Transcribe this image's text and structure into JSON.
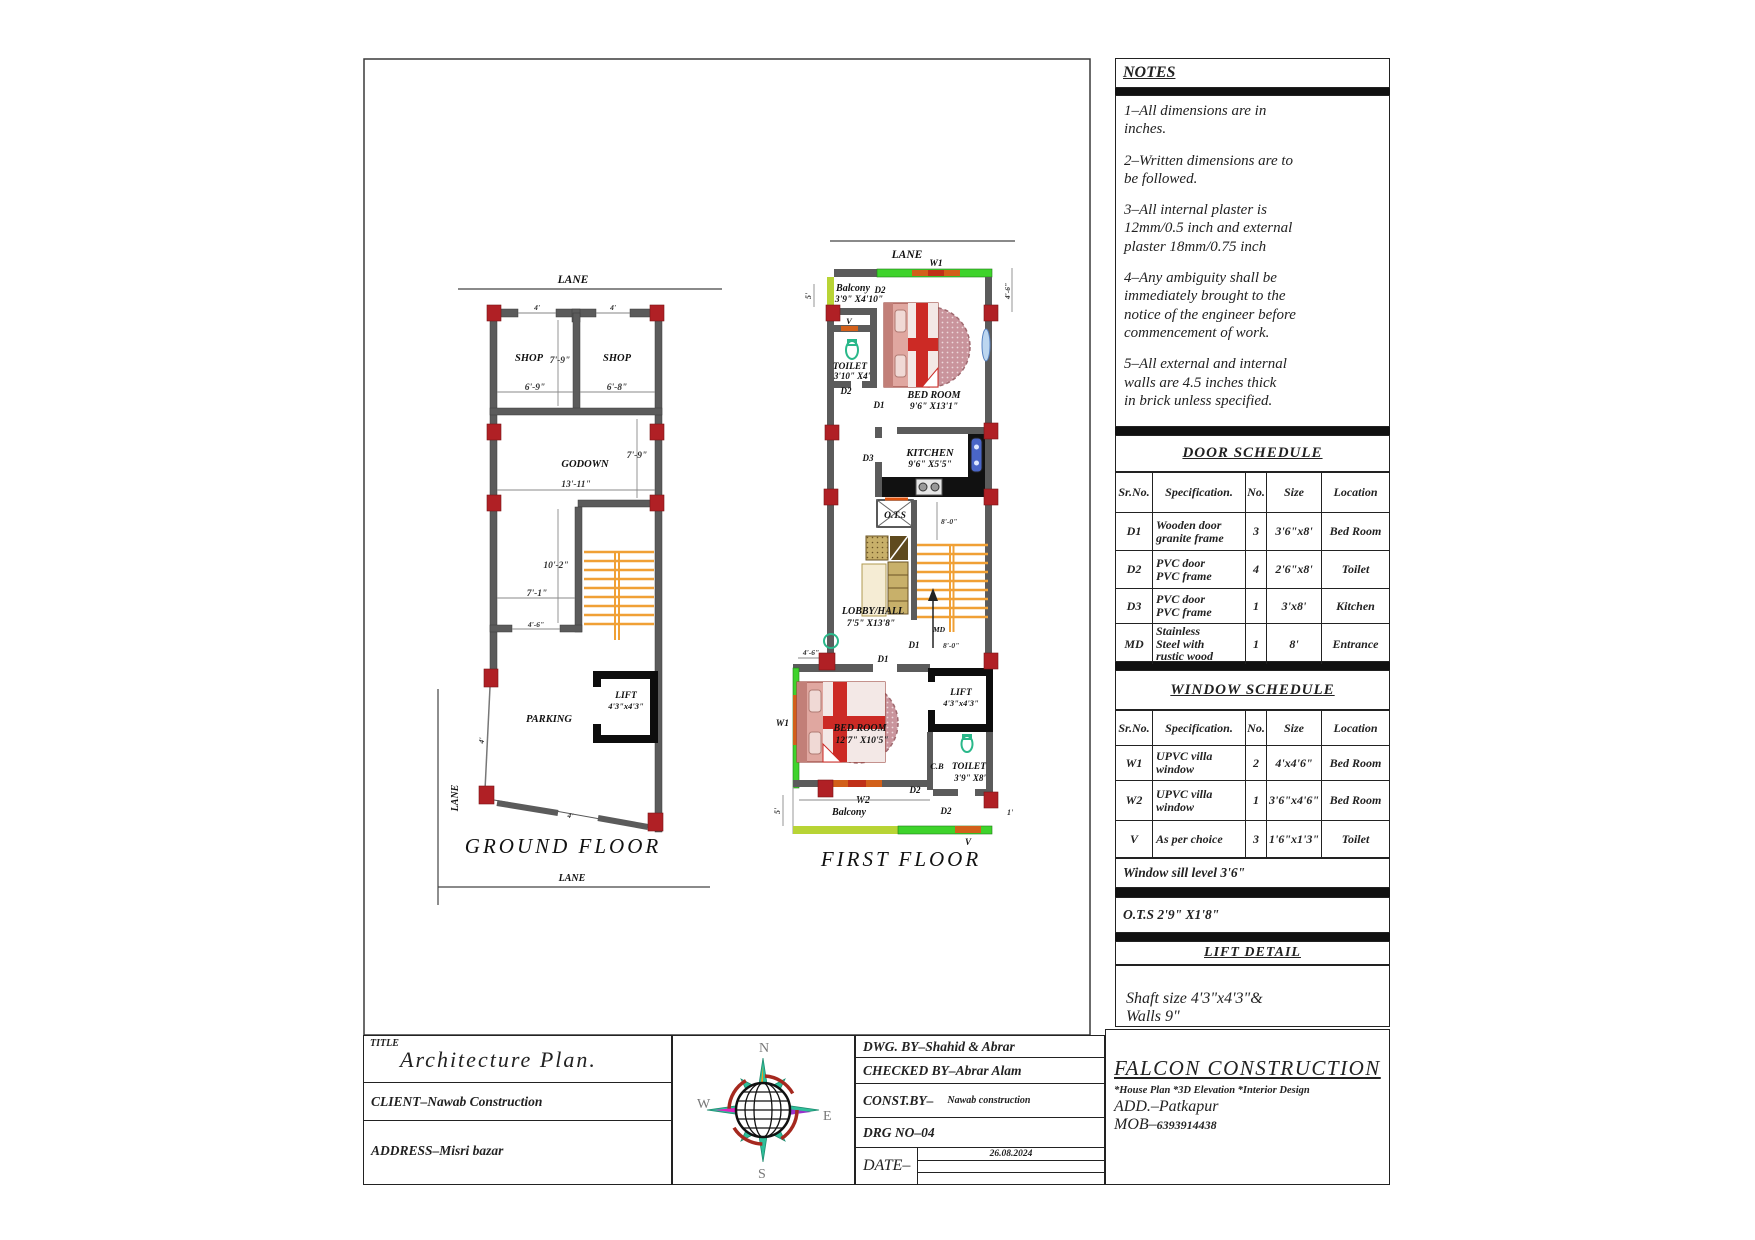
{
  "colors": {
    "wall": "#5b5b5b",
    "column": "#b02025",
    "stair": "#f0a035",
    "green": "#3ed32b",
    "lime": "#b8d435",
    "window_orange": "#d2601a",
    "shaft_black": "#0d0d0d",
    "teal": "#2ab88a",
    "basin_blue": "#4a66c8",
    "bed_red": "#cc2a25"
  },
  "ground_floor": {
    "title": "GROUND FLOOR",
    "lane_top": "LANE",
    "lane_bottom": "LANE",
    "lane_left": "LANE",
    "shop1": "SHOP",
    "shop2": "SHOP",
    "godown": "GODOWN",
    "parking": "PARKING",
    "lift": "LIFT",
    "lift_size": "4'3\"x4'3\"",
    "dim_shop_h": "7'-9\"",
    "dim_shop1_w": "6'-9\"",
    "dim_shop2_w": "6'-8\"",
    "dim_godown_h": "7'-9\"",
    "dim_godown_w": "13'-11\"",
    "dim_hall_h": "10'-2\"",
    "dim_hall_w": "7'-1\"",
    "dim_stair": "4'-6\"",
    "dim_door1": "4'",
    "dim_door2": "4'",
    "dim_slant_left": "4'",
    "dim_slant_bottom": "4'"
  },
  "first_floor": {
    "title": "FIRST FLOOR",
    "lane_top": "LANE",
    "w1_top": "W1",
    "balcony_top": "Balcony",
    "balcony_top_size": "3'9\" X4'10\"",
    "d2_balcony": "D2",
    "v_toilet": "V",
    "toilet1": "TOILET",
    "toilet1_size": "3'10\" X4'",
    "d2_toilet": "D2",
    "bedroom1": "BED ROOM",
    "bedroom1_size": "9'6\" X13'1\"",
    "d1_bedroom1": "D1",
    "d3": "D3",
    "kitchen": "KITCHEN",
    "kitchen_size": "9'6\" X5'5\"",
    "ots": "O.T.S",
    "lobby": "LOBBY/HALL",
    "lobby_size": "7'5\" X13'8\"",
    "dim_stair_top": "8'-0\"",
    "dim_stair_bot": "8'-0\"",
    "md": "MD",
    "d1_stair": "D1",
    "dim_bed2_top": "4'-6\"",
    "d1_bedroom2": "D1",
    "w1_side": "W1",
    "bedroom2": "BED ROOM",
    "bedroom2_size": "12'7\" X10'5\"",
    "lift": "LIFT",
    "lift_size": "4'3\"x4'3\"",
    "cb": "C.B",
    "toilet2": "TOILET",
    "toilet2_size": "3'9\" X8'",
    "d2_bed2": "D2",
    "d2_toilet2": "D2",
    "w2": "W2",
    "balcony_bottom": "Balcony",
    "v_bottom": "V",
    "dim_left_top": "5'",
    "dim_right_top": "4'-6\"",
    "dim_left_bot": "5'",
    "dim_right_bot": "1'"
  },
  "notes": {
    "title": "NOTES",
    "items": [
      "1–All dimensions are in\ninches.",
      "2–Written dimensions are to\nbe followed.",
      "3–All internal plaster is\n12mm/0.5 inch and external\nplaster 18mm/0.75 inch",
      "4–Any ambiguity shall be\nimmediately brought to the\nnotice of the engineer before\ncommencement of work.",
      "5–All external and internal\nwalls are 4.5 inches thick\nin brick unless specified."
    ]
  },
  "door_schedule": {
    "title": "DOOR SCHEDULE",
    "headers": [
      "Sr.No.",
      "Specification.",
      "No.",
      "Size",
      "Location"
    ],
    "rows": [
      {
        "sr": "D1",
        "spec": "Wooden door\ngranite frame",
        "no": "3",
        "size": "3'6\"x8'",
        "loc": "Bed Room"
      },
      {
        "sr": "D2",
        "spec": "PVC door\nPVC frame",
        "no": "4",
        "size": "2'6\"x8'",
        "loc": "Toilet"
      },
      {
        "sr": "D3",
        "spec": "PVC door\nPVC frame",
        "no": "1",
        "size": "3'x8'",
        "loc": "Kitchen"
      },
      {
        "sr": "MD",
        "spec": "Stainless\nSteel with\nrustic wood",
        "no": "1",
        "size": "8'",
        "loc": "Entrance"
      }
    ]
  },
  "window_schedule": {
    "title": "WINDOW SCHEDULE",
    "headers": [
      "Sr.No.",
      "Specification.",
      "No.",
      "Size",
      "Location"
    ],
    "rows": [
      {
        "sr": "W1",
        "spec": "UPVC villa\nwindow",
        "no": "2",
        "size": "4'x4'6\"",
        "loc": "Bed Room"
      },
      {
        "sr": "W2",
        "spec": "UPVC villa\nwindow",
        "no": "1",
        "size": "3'6\"x4'6\"",
        "loc": "Bed Room"
      },
      {
        "sr": "V",
        "spec": "As per choice",
        "no": "3",
        "size": "1'6\"x1'3\"",
        "loc": "Toilet"
      }
    ],
    "sill_note": "Window sill level 3'6\"",
    "ots_note": "O.T.S 2'9\" X1'8\""
  },
  "lift_detail": {
    "title": "LIFT DETAIL",
    "text": "Shaft size 4'3\"x4'3\"&\nWalls 9\""
  },
  "title_block": {
    "title_label": "TITLE",
    "title": "Architecture Plan.",
    "client": "CLIENT–Nawab Construction",
    "address": "ADDRESS–Misri bazar",
    "dwg_by": "DWG. BY–Shahid & Abrar",
    "checked_by": "CHECKED BY–Abrar Alam",
    "const_by": "CONST.BY–",
    "const_by_value": "Nawab construction",
    "drg_no": "DRG NO–04",
    "date_label": "DATE–",
    "date": "26.08.2024",
    "company": "FALCON CONSTRUCTION",
    "services": "*House Plan *3D Elevation *Interior Design",
    "company_add": "ADD.–Patkapur",
    "company_mob": "MOB–",
    "company_mob_no": "6393914438",
    "compass": {
      "n": "N",
      "s": "S",
      "e": "E",
      "w": "W"
    }
  }
}
